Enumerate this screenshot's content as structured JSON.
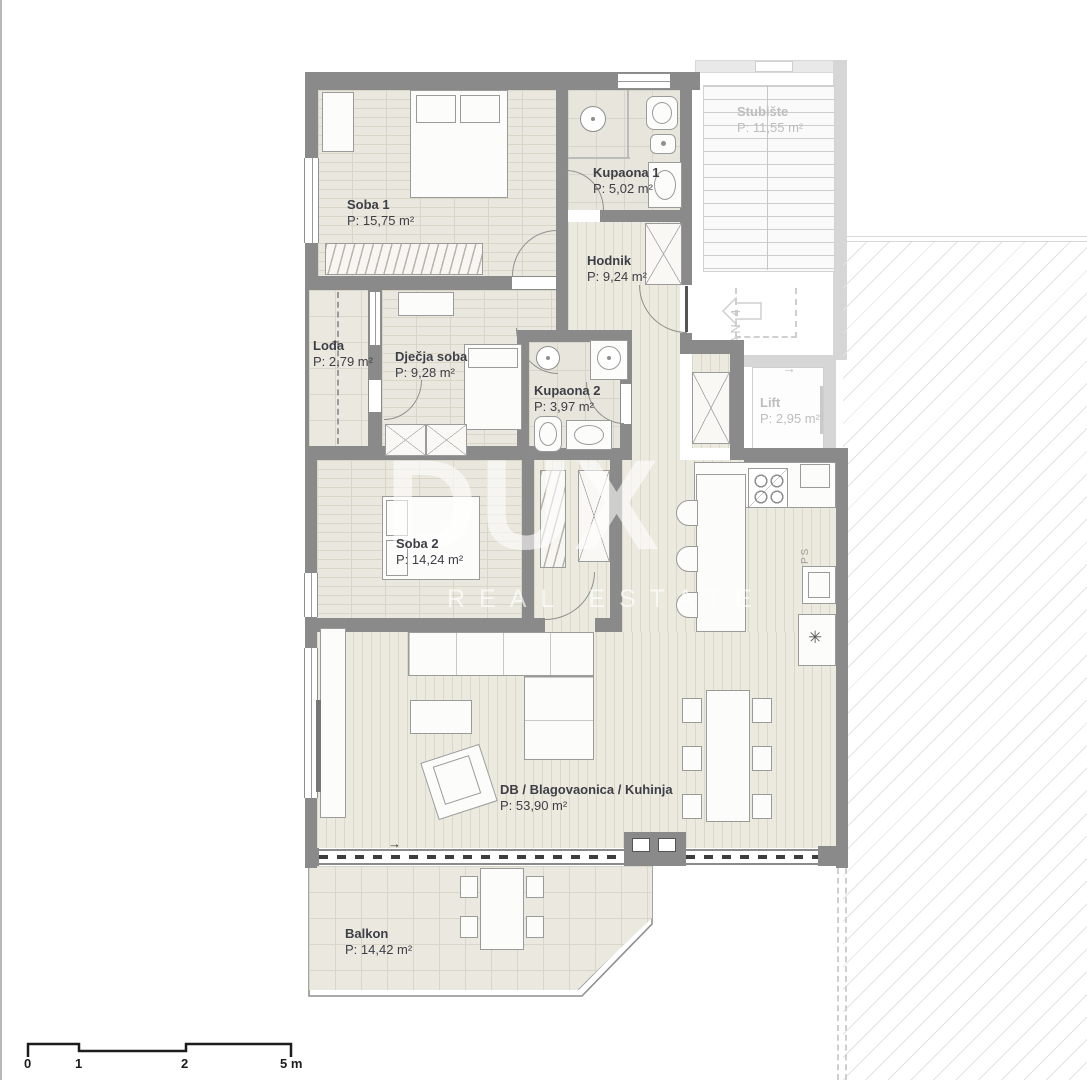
{
  "plan": {
    "rooms": [
      {
        "id": "soba1",
        "name": "Soba 1",
        "area": "P: 15,75 m²"
      },
      {
        "id": "kupaona1",
        "name": "Kupaona 1",
        "area": "P: 5,02 m²"
      },
      {
        "id": "hodnik",
        "name": "Hodnik",
        "area": "P: 9,24 m²"
      },
      {
        "id": "lodja",
        "name": "Lođa",
        "area": "P: 2,79 m²"
      },
      {
        "id": "djecja",
        "name": "Dječja soba",
        "area": "P: 9,28 m²"
      },
      {
        "id": "kupaona2",
        "name": "Kupaona 2",
        "area": "P: 3,97 m²"
      },
      {
        "id": "soba2",
        "name": "Soba 2",
        "area": "P: 14,24 m²"
      },
      {
        "id": "dnevni",
        "name": "DB / Blagovaonica / Kuhinja",
        "area": "P: 53,90 m²"
      },
      {
        "id": "balkon",
        "name": "Balkon",
        "area": "P: 14,42 m²"
      }
    ],
    "common_areas": [
      {
        "id": "stubiste",
        "name": "Stubište",
        "area": "P: 11,55 m²"
      },
      {
        "id": "lift",
        "name": "Lift",
        "area": "P: 2,95 m²"
      }
    ],
    "annotations": {
      "unit": "STAN 4",
      "shaft": "PS"
    }
  },
  "watermark": {
    "line1": "DUX",
    "line2": "REAL ESTATE"
  },
  "scale_bar": {
    "labels": [
      "0",
      "1",
      "2",
      "5 m"
    ]
  },
  "icons": {
    "arrow_right": "→",
    "boiler": "✳"
  },
  "colors": {
    "wall": "#8a8a8a",
    "floor": "#eae8de",
    "label": "#3e3e47",
    "faded_label": "#bdbdbd",
    "hatch_line": "#e3e3e3"
  }
}
